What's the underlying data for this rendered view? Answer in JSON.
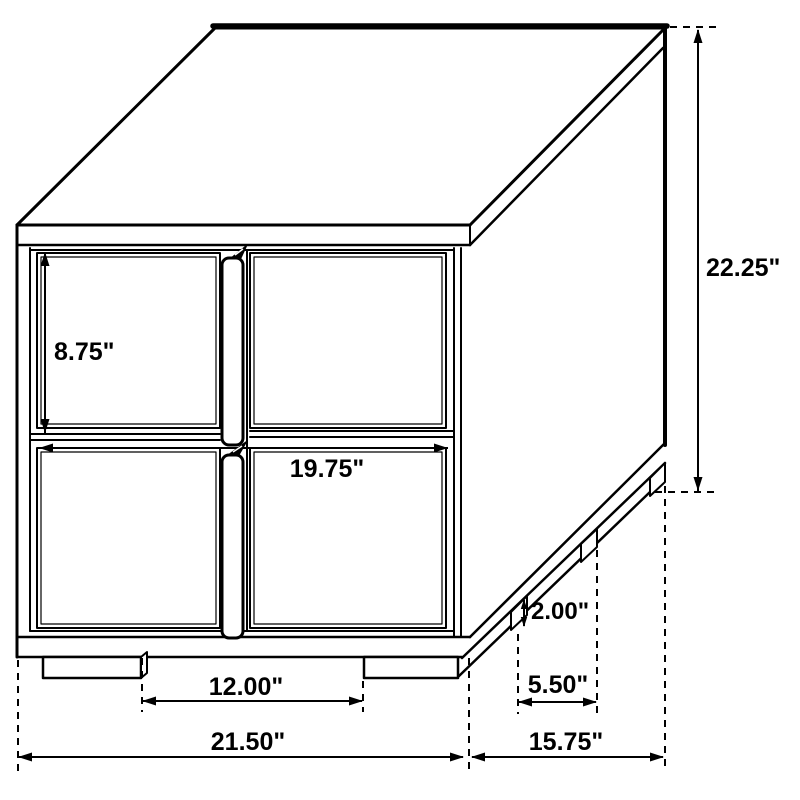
{
  "page": {
    "background": "#ffffff",
    "title": "Two-drawer nightstand dimension drawing"
  },
  "diagram": {
    "type": "furniture-dimension-line-drawing",
    "subject": "2-drawer nightstand, isometric view, center vertical pull handles, recessed base with legs",
    "unit": "inches",
    "line_color": "#000000",
    "labels": {
      "overall_height": "22.25\"",
      "top_drawer_height": "8.75\"",
      "drawer_front_width": "19.75\"",
      "base_height": "2.00\"",
      "side_leg_gap": "5.50\"",
      "front_leg_gap": "12.00\"",
      "overall_width": "21.50\"",
      "overall_depth": "15.75\""
    },
    "values": {
      "overall_height": 22.25,
      "top_drawer_height": 8.75,
      "drawer_front_width": 19.75,
      "base_height": 2.0,
      "side_leg_gap": 5.5,
      "front_leg_gap": 12.0,
      "overall_width": 21.5,
      "overall_depth": 15.75
    }
  }
}
